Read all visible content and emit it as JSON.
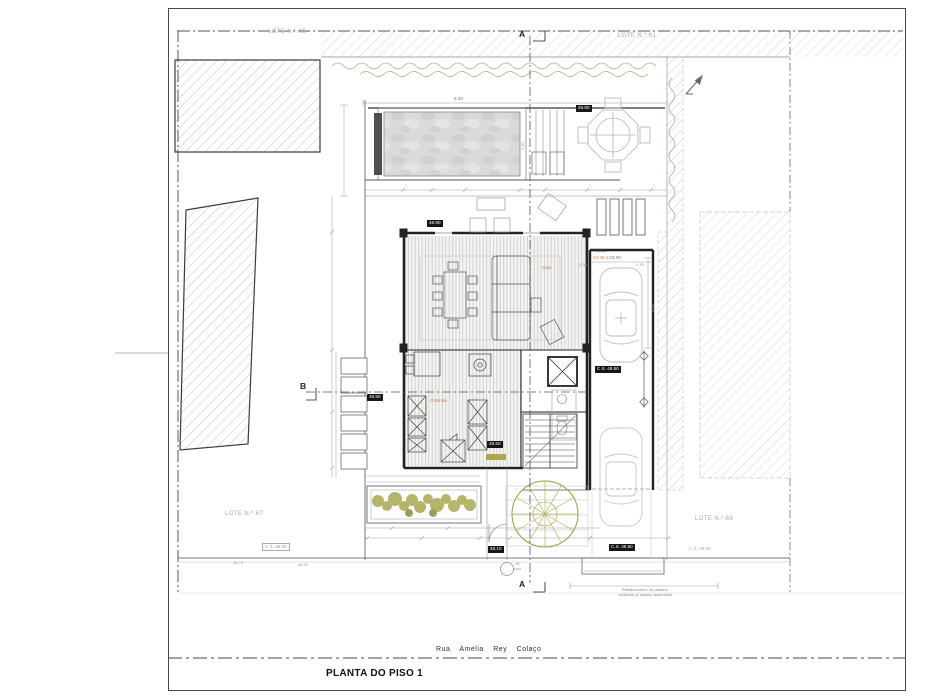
{
  "meta": {
    "title": "PLANTA DO PISO 1"
  },
  "street": {
    "name": "Rua Amelia Rey Colaço"
  },
  "lots": {
    "top_left": "LOTE N.º 65",
    "top_right": "LOTE N.º 61",
    "bottom_left": "LOTE N.º 67",
    "bottom_right": "LOTE N.º 69"
  },
  "sections": {
    "a": "A",
    "b": "B"
  },
  "rooms": {
    "annex": "Anexo",
    "annex_area": "14.35 m2",
    "living": "Sala",
    "kitchen": "Cozinha"
  },
  "elevations": {
    "terrace": "48.90",
    "pool": "48.90",
    "stair": "48.50",
    "entry": "48.50",
    "garage": "C.S. 48.50",
    "curb_black": "C.S. 48.50",
    "entry_path": "48.10",
    "left_light": "C.S. 48.50",
    "right_light": "C.S. 48.50",
    "side_a": "48.70",
    "side_b": "48.30",
    "manhole": "48"
  },
  "dims": {
    "pool_len": "8.30",
    "pool_w": "2.90",
    "garage_w": "3.00",
    "garage_d": "6.00",
    "off_a": "0.30",
    "off_b": "0.30"
  },
  "notes": {
    "curb_1": "Rebaixamento do passeio",
    "curb_2": "existente p/ acesso automóvel"
  }
}
